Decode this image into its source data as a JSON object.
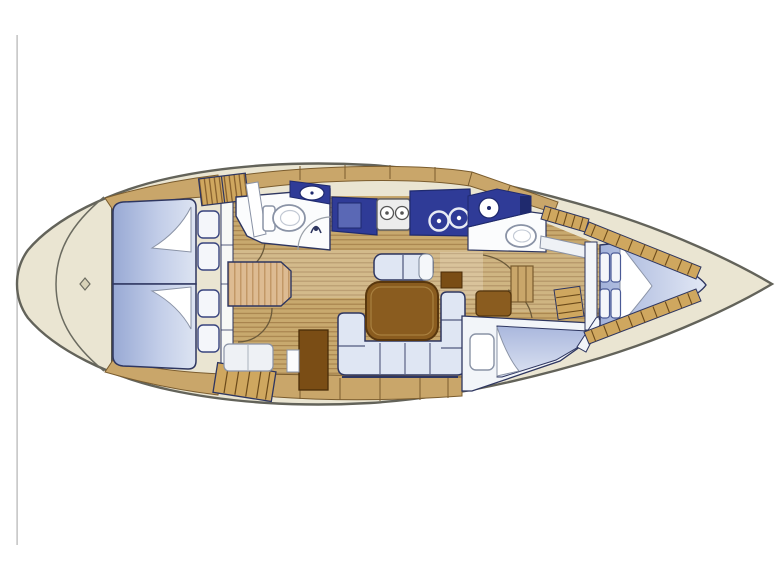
{
  "diagram": {
    "type": "sailboat-interior-floor-plan-top-view",
    "orientation": "bow-right",
    "rooms": [
      "stern-platform",
      "aft-cabin-port",
      "aft-cabin-starboard",
      "aft-head-with-shower",
      "nav-station",
      "companionway-steps",
      "galley",
      "salon-with-u-settee-and-table",
      "forward-head",
      "forward-cabin-starboard",
      "v-berth-cabin",
      "anchor-locker-bow"
    ]
  },
  "colors": {
    "page_background": "#ffffff",
    "artifact_line": "#bdbdbd",
    "hull_fill": "#eae5d2",
    "hull_outline": "#63635a",
    "wood_floor": "#c8a96e",
    "wood_floor_stripe": "#a5814b",
    "wood_trim": "#c9a66a",
    "wood_trim_outline": "#7a5c2e",
    "wood_hatch": "#cfa75f",
    "berth_dark": "#9dadd6",
    "berth_light": "#dfe6f3",
    "berth_outline": "#2e3660",
    "counter_navy": "#2f3b97",
    "counter_navy_dark": "#1f2a6e",
    "sink_inner_blue": "#5a68b5",
    "fixture_white": "#fbfcfd",
    "fixture_outline": "#8a93a6",
    "stove_gray": "#ececec",
    "table_brown": "#8a5c1f",
    "table_brown_dark": "#59370d",
    "seat_brown": "#7a4d15",
    "chart_table_tan": "#ddbb92",
    "chart_table_stripe": "#bb905c"
  }
}
